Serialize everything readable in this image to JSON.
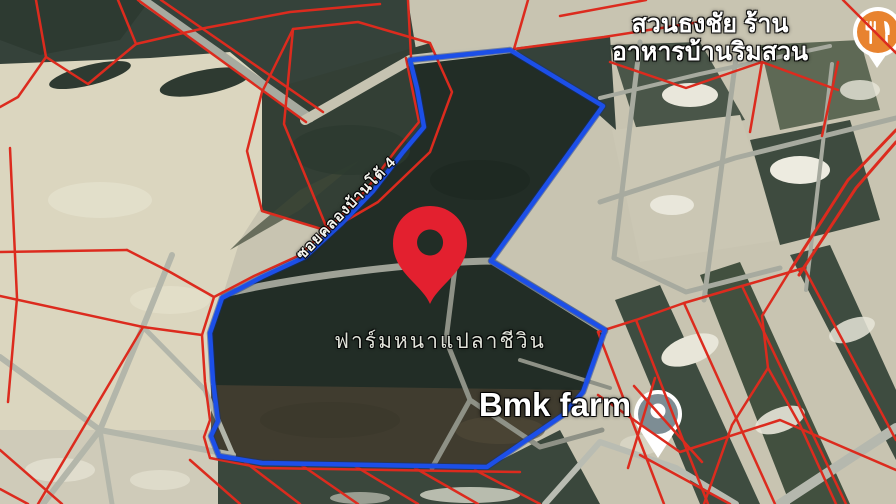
{
  "window": {
    "width": 896,
    "height": 504,
    "kind": "satellite-map-view"
  },
  "map": {
    "pois": {
      "restaurant": {
        "name_line1": "สวนธงชัย ร้าน",
        "name_line2": "อาหารบ้านริมสวน",
        "icon": "restaurant-icon",
        "pin_color": "#E8832F"
      },
      "bmk_farm": {
        "name": "Bmk farm",
        "icon": "place-pin-icon",
        "pin_color": "#7D8D94"
      }
    },
    "road_label": "ซอยคลองบ้านโต้ 4",
    "area_label": "ฟาร์มหนาแปลาชีวิน",
    "marker": {
      "icon": "location-pin-icon",
      "color": "#E3202F"
    },
    "overlay_colors": {
      "parcel_lines": "#DC2B1E",
      "selected_boundary": "#1C4FE8"
    }
  }
}
